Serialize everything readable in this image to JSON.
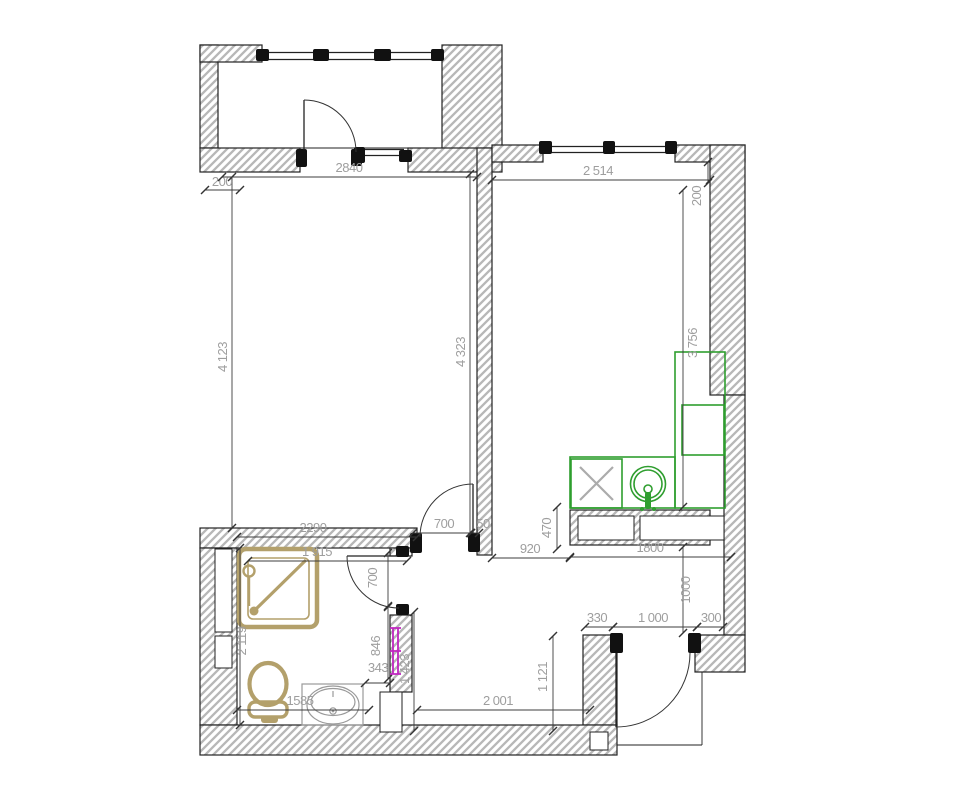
{
  "title": "Apartment floor plan drawing",
  "colors": {
    "kitchen_outline": "#2f9e2f",
    "sanitary_outline": "#b3a06b",
    "towel_rail": "#c026c0",
    "wall_hatch": "#b7b7b7",
    "dimension_text": "#9e9e9e"
  },
  "dims": {
    "balcony_door_wall": "2840",
    "left_wall_thickness": "200",
    "right_room_width": "2 514",
    "right_wall_offset": "200",
    "left_room_depth_left": "4 123",
    "left_room_depth_right": "4 323",
    "right_room_depth": "3 756",
    "bathroom_width": "2290",
    "bathroom_inner_width": "1 915",
    "room_door_width": "700",
    "room_door_offset": "50",
    "kitchen_wall_band": "470",
    "corridor_opening": "920",
    "kitchen_wall_length": "1800",
    "kitchen_niche_depth": "1000",
    "entry_left_offset": "330",
    "entry_door_width": "1 000",
    "entry_right_offset": "300",
    "hall_depth": "1 121",
    "hall_width": "2 001",
    "sink_wall_length": "1585",
    "bathroom_depth": "2 119",
    "towel_wall_segment": "846",
    "sink_offset": "343",
    "bath_corridor_depth": "1 423",
    "bath_door_width": "700"
  }
}
